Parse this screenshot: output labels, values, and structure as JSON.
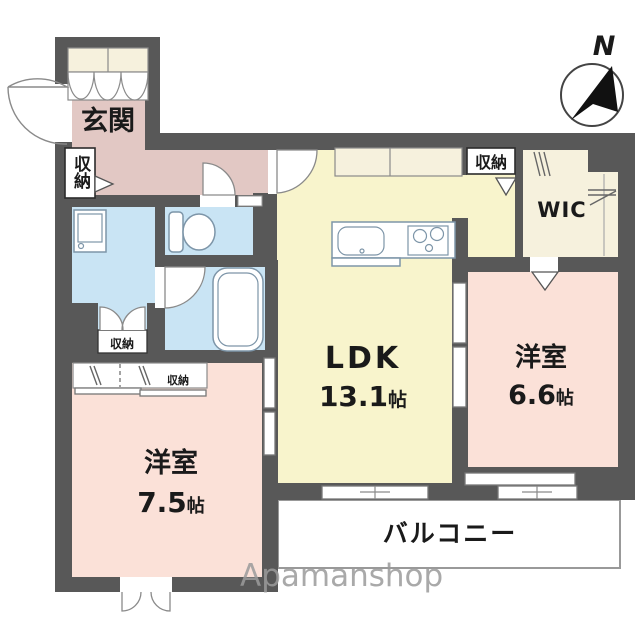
{
  "plan": {
    "watermark": "Apamanshop",
    "compass": {
      "north_label": "N"
    },
    "rooms": {
      "entrance": {
        "label": "玄関"
      },
      "hall_closet": {
        "label": "収納"
      },
      "washroom_closet": {
        "label": "収納"
      },
      "ldk": {
        "label": "LDK",
        "area": "13.1",
        "unit": "帖"
      },
      "ldk_top_closet": {
        "label": "収納"
      },
      "wic": {
        "label": "WIC"
      },
      "bedroom_east": {
        "label": "洋室",
        "area": "6.6",
        "unit": "帖"
      },
      "bedroom_south": {
        "label": "洋室",
        "area": "7.5",
        "unit": "帖"
      },
      "bedroom_south_closet": {
        "label": "収納"
      },
      "balcony": {
        "label": "バルコニー"
      }
    },
    "colors": {
      "wall": "#585858",
      "entrance_hall": "#e2c8c4",
      "bedroom": "#fbe1d8",
      "ldk": "#f8f4cc",
      "wet_area": "#c9e4f4",
      "closet": "#f6f1dd",
      "balcony": "#ffffff"
    }
  }
}
